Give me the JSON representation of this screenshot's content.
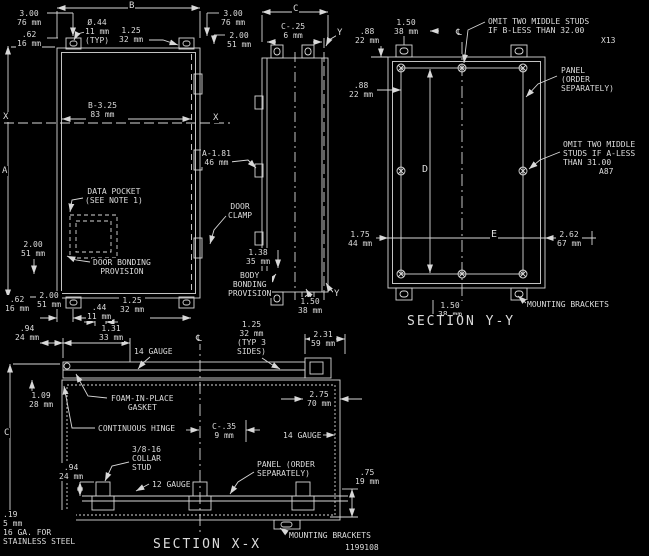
{
  "meta": {
    "sheet_type": "engineering drawing",
    "background": "#000000",
    "line_color": "#d8d8d8",
    "part_number": "1199108",
    "section_titles": [
      "SECTION Y-Y",
      "SECTION X-X"
    ]
  },
  "labels": [
    {
      "name": "dim-b-label",
      "x": 128,
      "y": 1,
      "size": 9,
      "lines": [
        "B"
      ]
    },
    {
      "name": "dim-a-label",
      "x": 1,
      "y": 166,
      "size": 9,
      "lines": [
        "A"
      ]
    },
    {
      "name": "dim-c-top-label",
      "x": 292,
      "y": 4,
      "size": 9,
      "lines": [
        "C"
      ]
    },
    {
      "name": "dim-3.00-76-left",
      "x": 16,
      "y": 9,
      "lines": [
        "3.00",
        "76 mm"
      ]
    },
    {
      "name": "dim-.62-16-left",
      "x": 16,
      "y": 30,
      "lines": [
        ".62",
        "16 mm"
      ]
    },
    {
      "name": "dim-dia-.44-typ",
      "x": 84,
      "y": 18,
      "lines": [
        "Ø.44",
        "11 mm",
        "(TYP)"
      ]
    },
    {
      "name": "dim-1.25-32-top",
      "x": 118,
      "y": 26,
      "lines": [
        "1.25",
        "32 mm"
      ]
    },
    {
      "name": "dim-3.00-76-right",
      "x": 220,
      "y": 9,
      "lines": [
        "3.00",
        "76 mm"
      ]
    },
    {
      "name": "dim-2.00-51-right",
      "x": 226,
      "y": 31,
      "lines": [
        "2.00",
        "51 mm"
      ]
    },
    {
      "name": "dim-c-.25-6",
      "x": 280,
      "y": 22,
      "lines": [
        "C-.25",
        "6 mm"
      ]
    },
    {
      "name": "marker-y-top",
      "x": 336,
      "y": 28,
      "size": 9,
      "lines": [
        "Y"
      ]
    },
    {
      "name": "centerline-symbol-yy",
      "x": 455,
      "y": 28,
      "size": 9,
      "lines": [
        "℄"
      ]
    },
    {
      "name": "marker-x-left",
      "x": 2,
      "y": 112,
      "size": 9,
      "lines": [
        "X"
      ]
    },
    {
      "name": "marker-x-right",
      "x": 212,
      "y": 113,
      "size": 9,
      "lines": [
        "X"
      ]
    },
    {
      "name": "dim-b-3.25-83",
      "x": 87,
      "y": 101,
      "lines": [
        "B-3.25",
        "83 mm"
      ]
    },
    {
      "name": "dim-a-1.81-46",
      "x": 201,
      "y": 149,
      "lines": [
        "A-1.81",
        "46 mm"
      ]
    },
    {
      "name": "note-data-pocket",
      "x": 84,
      "y": 187,
      "lines": [
        "DATA POCKET",
        "(SEE NOTE 1)"
      ]
    },
    {
      "name": "note-door-clamp",
      "x": 227,
      "y": 202,
      "lines": [
        "DOOR",
        "CLAMP"
      ]
    },
    {
      "name": "dim-2.00-51-pocket",
      "x": 20,
      "y": 240,
      "lines": [
        "2.00",
        "51 mm"
      ]
    },
    {
      "name": "dim-1.38-35",
      "x": 245,
      "y": 248,
      "lines": [
        "1.38",
        "35 mm"
      ]
    },
    {
      "name": "note-door-bonding",
      "x": 92,
      "y": 258,
      "lines": [
        "DOOR BONDING",
        "PROVISION"
      ]
    },
    {
      "name": "note-body-bonding",
      "x": 227,
      "y": 271,
      "lines": [
        "BODY",
        "BONDING",
        "PROVISION"
      ]
    },
    {
      "name": "dim-1.50-38-side",
      "x": 297,
      "y": 297,
      "lines": [
        "1.50",
        "38 mm"
      ]
    },
    {
      "name": "marker-y-bottom",
      "x": 333,
      "y": 289,
      "size": 9,
      "lines": [
        "Y"
      ]
    },
    {
      "name": "dim-.62-16-bottom",
      "x": 4,
      "y": 295,
      "lines": [
        ".62",
        "16 mm"
      ]
    },
    {
      "name": "dim-2.00-51-bottom",
      "x": 36,
      "y": 291,
      "lines": [
        "2.00",
        "51 mm"
      ]
    },
    {
      "name": "dim-.44-11-bottom",
      "x": 86,
      "y": 303,
      "lines": [
        ".44",
        "11 mm"
      ]
    },
    {
      "name": "dim-1.25-32-bottom",
      "x": 119,
      "y": 296,
      "lines": [
        "1.25",
        "32 mm"
      ]
    },
    {
      "name": "dim-1.50-38-yy-top",
      "x": 393,
      "y": 18,
      "lines": [
        "1.50",
        "38 mm"
      ]
    },
    {
      "name": "dim-.88-22-top",
      "x": 354,
      "y": 27,
      "lines": [
        ".88",
        "22 mm"
      ]
    },
    {
      "name": "dim-.88-22-side",
      "x": 348,
      "y": 81,
      "lines": [
        ".88",
        "22 mm"
      ]
    },
    {
      "name": "note-omit-studs-b",
      "x": 487,
      "y": 17,
      "ta": "l",
      "lines": [
        "OMIT TWO MIDDLE STUDS",
        "IF B-LESS THAN 32.00"
      ]
    },
    {
      "name": "note-omit-studs-b-flag",
      "x": 600,
      "y": 36,
      "lines": [
        "X13"
      ]
    },
    {
      "name": "note-panel-yy",
      "x": 560,
      "y": 66,
      "ta": "l",
      "lines": [
        "PANEL",
        "(ORDER",
        "SEPARATELY)"
      ]
    },
    {
      "name": "note-omit-studs-a",
      "x": 562,
      "y": 140,
      "ta": "l",
      "lines": [
        "OMIT TWO MIDDLE",
        "STUDS IF A-LESS",
        "THAN 31.00"
      ]
    },
    {
      "name": "note-omit-studs-a-flag",
      "x": 598,
      "y": 167,
      "lines": [
        "A87"
      ]
    },
    {
      "name": "dim-d-label",
      "x": 421,
      "y": 164,
      "size": 10,
      "lines": [
        "D"
      ]
    },
    {
      "name": "dim-e-label",
      "x": 490,
      "y": 229,
      "size": 10,
      "lines": [
        "E"
      ]
    },
    {
      "name": "dim-1.75-44",
      "x": 347,
      "y": 230,
      "lines": [
        "1.75",
        "44 mm"
      ]
    },
    {
      "name": "dim-2.62-67",
      "x": 556,
      "y": 230,
      "lines": [
        "2.62",
        "67 mm"
      ]
    },
    {
      "name": "dim-1.50-38-yy-bottom",
      "x": 437,
      "y": 301,
      "lines": [
        "1.50",
        "38 mm"
      ]
    },
    {
      "name": "note-mounting-brackets-yy",
      "x": 526,
      "y": 300,
      "lines": [
        "MOUNTING BRACKETS"
      ]
    },
    {
      "name": "title-section-yy",
      "x": 406,
      "y": 315,
      "size": 13,
      "ls": 2,
      "lines": [
        "SECTION Y-Y"
      ]
    },
    {
      "name": "dim-.94-24-top",
      "x": 14,
      "y": 324,
      "lines": [
        ".94",
        "24 mm"
      ]
    },
    {
      "name": "dim-1.31-33",
      "x": 98,
      "y": 324,
      "lines": [
        "1.31",
        "33 mm"
      ]
    },
    {
      "name": "centerline-symbol-xx",
      "x": 195,
      "y": 334,
      "size": 9,
      "lines": [
        "℄"
      ]
    },
    {
      "name": "note-14-gauge-top",
      "x": 133,
      "y": 347,
      "lines": [
        "14 GAUGE"
      ]
    },
    {
      "name": "dim-1.25-32-typ-3-sides",
      "x": 236,
      "y": 320,
      "lines": [
        "1.25",
        "32 mm",
        "(TYP 3",
        "SIDES)"
      ]
    },
    {
      "name": "dim-2.31-59",
      "x": 310,
      "y": 330,
      "lines": [
        "2.31",
        "59 mm"
      ]
    },
    {
      "name": "dim-2.75-70",
      "x": 306,
      "y": 390,
      "lines": [
        "2.75",
        "70 mm"
      ]
    },
    {
      "name": "note-foam-gasket",
      "x": 110,
      "y": 394,
      "lines": [
        "FOAM-IN-PLACE",
        "GASKET"
      ]
    },
    {
      "name": "dim-1.09-28",
      "x": 28,
      "y": 391,
      "lines": [
        "1.09",
        "28 mm"
      ]
    },
    {
      "name": "note-continuous-hinge",
      "x": 97,
      "y": 424,
      "lines": [
        "CONTINUOUS HINGE"
      ]
    },
    {
      "name": "dim-c-.35-9",
      "x": 211,
      "y": 422,
      "lines": [
        "C-.35",
        "9 mm"
      ]
    },
    {
      "name": "note-14-gauge-right",
      "x": 282,
      "y": 431,
      "lines": [
        "14 GAUGE"
      ]
    },
    {
      "name": "dim-c-left-label",
      "x": 3,
      "y": 428,
      "size": 9,
      "lines": [
        "C"
      ]
    },
    {
      "name": "note-collar-stud",
      "x": 131,
      "y": 445,
      "ta": "l",
      "lines": [
        "3/8-16",
        "COLLAR",
        "STUD"
      ]
    },
    {
      "name": "dim-.94-24-stud",
      "x": 58,
      "y": 463,
      "lines": [
        ".94",
        "24 mm"
      ]
    },
    {
      "name": "note-12-gauge",
      "x": 151,
      "y": 480,
      "lines": [
        "12 GAUGE"
      ]
    },
    {
      "name": "note-panel-xx",
      "x": 256,
      "y": 460,
      "ta": "l",
      "lines": [
        "PANEL (ORDER",
        "SEPARATELY)"
      ]
    },
    {
      "name": "dim-.75-19",
      "x": 354,
      "y": 468,
      "lines": [
        ".75",
        "19 mm"
      ]
    },
    {
      "name": "note-material",
      "x": 2,
      "y": 510,
      "ta": "l",
      "lines": [
        ".19",
        "5 mm",
        "16 GA. FOR",
        "STAINLESS STEEL"
      ]
    },
    {
      "name": "note-mounting-brackets-xx",
      "x": 288,
      "y": 531,
      "lines": [
        "MOUNTING BRACKETS"
      ]
    },
    {
      "name": "title-section-xx",
      "x": 152,
      "y": 538,
      "size": 13,
      "ls": 2,
      "lines": [
        "SECTION X-X"
      ]
    },
    {
      "name": "part-number",
      "x": 344,
      "y": 543,
      "lines": [
        "1199108"
      ]
    }
  ]
}
